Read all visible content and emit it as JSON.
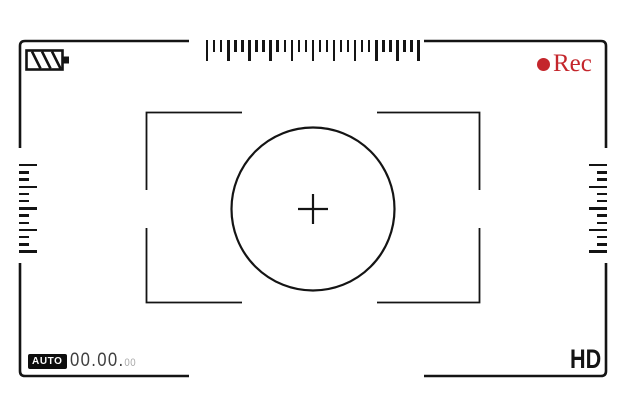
{
  "viewfinder": {
    "type": "camera-recording-screen",
    "rec": {
      "label": "Rec",
      "color": "#c4262c"
    },
    "battery": {
      "icon": "battery-striped-icon",
      "style": "diagonal-stripes"
    },
    "mode_badge": {
      "label": "AUTO"
    },
    "counter": {
      "main": "00.00.",
      "sub": "00"
    },
    "quality": {
      "label": "HD"
    },
    "focus": {
      "shape": "circle-with-crosshair",
      "brackets": 4
    }
  },
  "colors": {
    "line": "#141414",
    "rec_red": "#c4262c",
    "counter_main": "#3f3f3f",
    "counter_sub": "#a9a9a9",
    "background": "#ffffff"
  },
  "rulers": {
    "top": {
      "orientation": "horizontal",
      "pattern": [
        "L",
        "S",
        "S",
        "L",
        "S",
        "S",
        "L",
        "S",
        "S",
        "L",
        "S",
        "S",
        "L",
        "S",
        "S",
        "L",
        "S",
        "S",
        "L",
        "S",
        "S",
        "L",
        "S",
        "S",
        "L",
        "S",
        "S",
        "L",
        "S",
        "S",
        "L"
      ]
    },
    "left": {
      "orientation": "vertical",
      "pattern": [
        "L",
        "S",
        "S",
        "L",
        "S",
        "S",
        "L",
        "S",
        "S",
        "L",
        "S",
        "S",
        "L"
      ]
    },
    "right": {
      "orientation": "vertical",
      "pattern": [
        "L",
        "S",
        "S",
        "L",
        "S",
        "S",
        "L",
        "S",
        "S",
        "L",
        "S",
        "S",
        "L"
      ]
    }
  }
}
